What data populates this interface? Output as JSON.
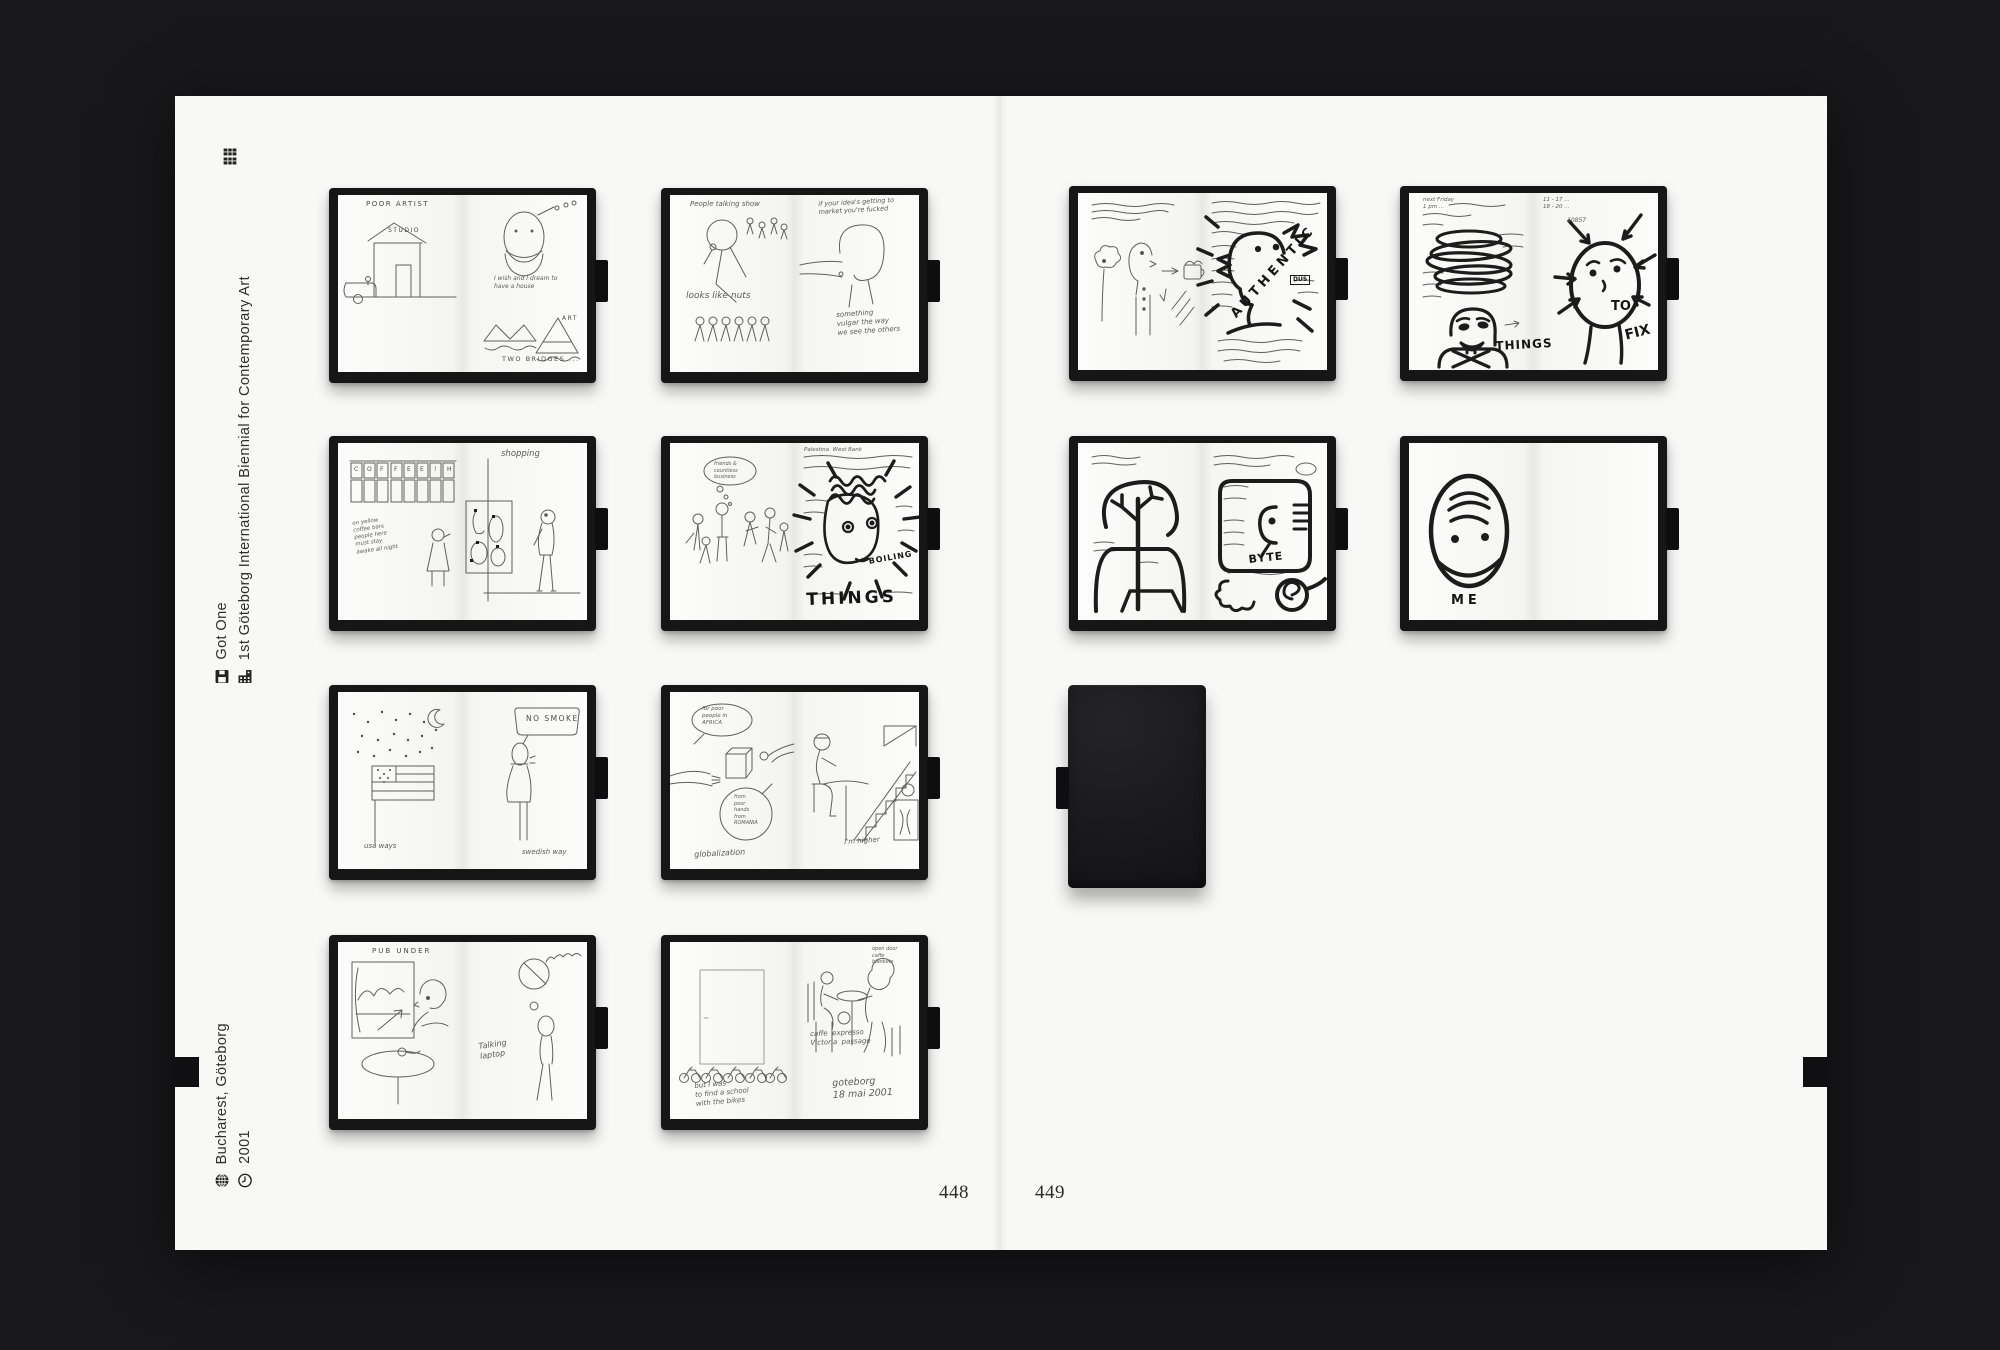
{
  "colors": {
    "background": "#18181b",
    "page": "#f8f8f6",
    "notebook_cover": "#161616",
    "pen_ink": "#5f5f5f",
    "marker_ink": "#1c1c1c"
  },
  "margin": {
    "top_icon": "grid-icon",
    "items": [
      {
        "icon": "floppy-icon",
        "label": "Got One"
      },
      {
        "icon": "building-icon",
        "label": "1st Göteborg International Biennial for Contemporary Art"
      },
      {
        "icon": "globe-icon",
        "label": "Bucharest, Göteborg"
      },
      {
        "icon": "clock-icon",
        "label": "2001"
      }
    ]
  },
  "page_numbers": {
    "left": "448",
    "right": "449"
  },
  "notebooks": [
    {
      "name": "poor-artist",
      "labels": {
        "title": "POOR ARTIST",
        "studio": "STUDIO",
        "wish": "I wish and I dream to\nhave a house",
        "art": "ART",
        "bridges": "TWO BRIDGES ..."
      }
    },
    {
      "name": "people-talking",
      "labels": {
        "top_left": "People talking show",
        "nuts": "looks like nuts",
        "top_right": "if your idea's getting to\nmarket you're fucked",
        "bottom_right": "something\nvulgar the way\nwe see the others"
      }
    },
    {
      "name": "coffee-shopping",
      "labels": {
        "letters": [
          "C",
          "O",
          "F",
          "F",
          "E",
          "E",
          "!",
          "H"
        ],
        "note": "on yellow\ncoffee bars\npeople here\nmust stay\nawake all night",
        "shopping": "shopping"
      }
    },
    {
      "name": "boiling-things",
      "labels": {
        "bubble": "friends &\ncountless\nbusiness",
        "notes": "Palestina  West Bank",
        "boiling": "BOILING",
        "things": "THINGS"
      }
    },
    {
      "name": "usa-swedish",
      "labels": {
        "left_caption": "usa ways",
        "bubble": "NO SMOKE",
        "right_caption": "swedish way"
      }
    },
    {
      "name": "globalization",
      "labels": {
        "bubble_top": "for poor\npeople in\nAFRICA",
        "bubble_bottom": "from\npoor\nhands\nfrom\nROMANIA",
        "caption": "globalization",
        "right_caption": "I'm higher"
      }
    },
    {
      "name": "pub-under",
      "labels": {
        "title": "PUB UNDER",
        "caption": "Talking\nlaptop"
      }
    },
    {
      "name": "goteborg-cafe",
      "labels": {
        "left_caption": "but I was\nto find a school\nwith the bikes",
        "top_right": "open door\ncaffe\nblankets",
        "mid_right": "caffe  expresso\nVictoria  passage",
        "date": "goteborg\n18 mai 2001"
      }
    },
    {
      "name": "authentic",
      "labels": {
        "big_word": "AUTHENTIC",
        "dus": "DUS"
      }
    },
    {
      "name": "things-to-fix",
      "labels": {
        "notes_left": "next Friday\n1 pm ...",
        "things": "THINGS",
        "notes_right": "11 - 17 ...\n18 - 20 ...",
        "phone": "10857",
        "to": "TO",
        "fix": "FIX"
      }
    },
    {
      "name": "byte",
      "labels": {
        "byte": "BYTE"
      }
    },
    {
      "name": "me",
      "labels": {
        "me": "ME"
      }
    }
  ],
  "closed_notebook": {
    "name": "closed-sketchbook"
  }
}
